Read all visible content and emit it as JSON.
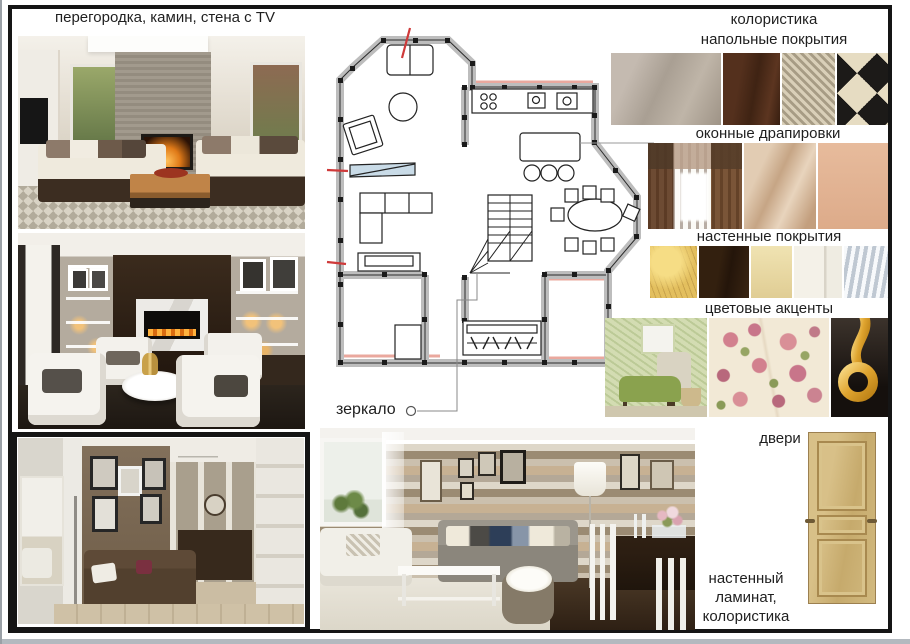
{
  "page": {
    "title": "перегородка, камин, стена с TV"
  },
  "plan": {
    "mirror_label": "зеркало"
  },
  "right_panel": {
    "flooring_label_1": "колористика",
    "flooring_label_2": "напольные покрытия",
    "curtains_label": "оконные драпировки",
    "wall_coverings_label": "настенные покрытия",
    "color_accents_label": "цветовые акценты",
    "doors_label": "двери",
    "laminate_caption_1": "настенный",
    "laminate_caption_2": "ламинат,",
    "laminate_caption_3": "колористика",
    "swatches": {
      "flooring": [
        "light-taupe-wood",
        "dark-brown-wood",
        "woven-sisal",
        "checkerboard-tile"
      ],
      "curtains": [
        "brown-curtains-window",
        "shimmer-plaster",
        "peach-paint"
      ],
      "wall_coverings": [
        "yellow-textured-plaster",
        "dark-wood-panel",
        "cream-plaster",
        "white-door-panel",
        "grey-louver"
      ],
      "color_accents": [
        "green-floral-room",
        "rose-floral-fabric",
        "gold-pendant"
      ]
    }
  },
  "colors": {
    "wall_grey": "#b9b9b9",
    "accent_red": "#cf3a3a",
    "accent_pink": "#eaa89e",
    "mirror_blue": "#c9dbe7",
    "gold": "#e8b84b",
    "door_wood": "#cbb279"
  }
}
